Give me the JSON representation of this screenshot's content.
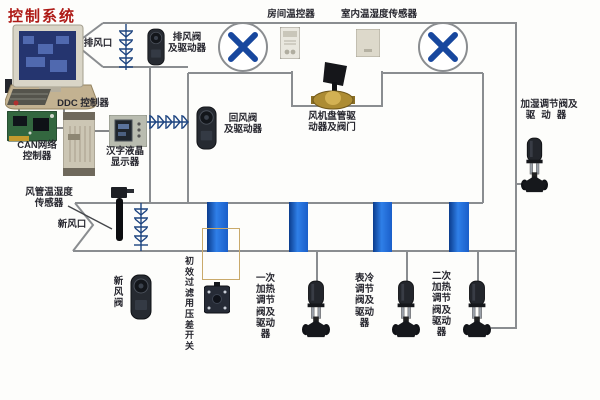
{
  "title": "控制系统",
  "colors": {
    "title_red": "#ae1a16",
    "duct_gray": "#8a8d90",
    "pipe_blue": "#1f5fc4",
    "fan_blade_blue": "#17479e",
    "symbol_navy": "#1d4480"
  },
  "station": {
    "ddc": "DDC 控制器",
    "can1": "CAN网络",
    "can2": "控制器",
    "lcd1": "汉字液晶",
    "lcd2": "显示器"
  },
  "air_side": {
    "exhaust_vent": "排风口",
    "exhaust_actuator1": "排风阀",
    "exhaust_actuator2": "及驱动器",
    "room_thermostat": "房间温控器",
    "indoor_sensor": "室内温湿度传感器",
    "return_actuator1": "回风阀",
    "return_actuator2": "及驱动器",
    "fan_coil1": "风机盘管驱",
    "fan_coil2": "动器及阀门",
    "humidifier1": "加湿调节阀及",
    "humidifier2": "驱动器",
    "duct_sensor1": "风管温湿度",
    "duct_sensor2": "传感器",
    "fresh_vent": "新风口",
    "fresh_valve": "新风阀"
  },
  "water_side": {
    "filter_switch": "初效过滤用压差开关",
    "valve_primary_heat": "一次加热调节阀及驱动器",
    "valve_cooling": "表冷调节阀及驱动器",
    "valve_secondary_heat": "二次加热调节阀及驱动器"
  }
}
